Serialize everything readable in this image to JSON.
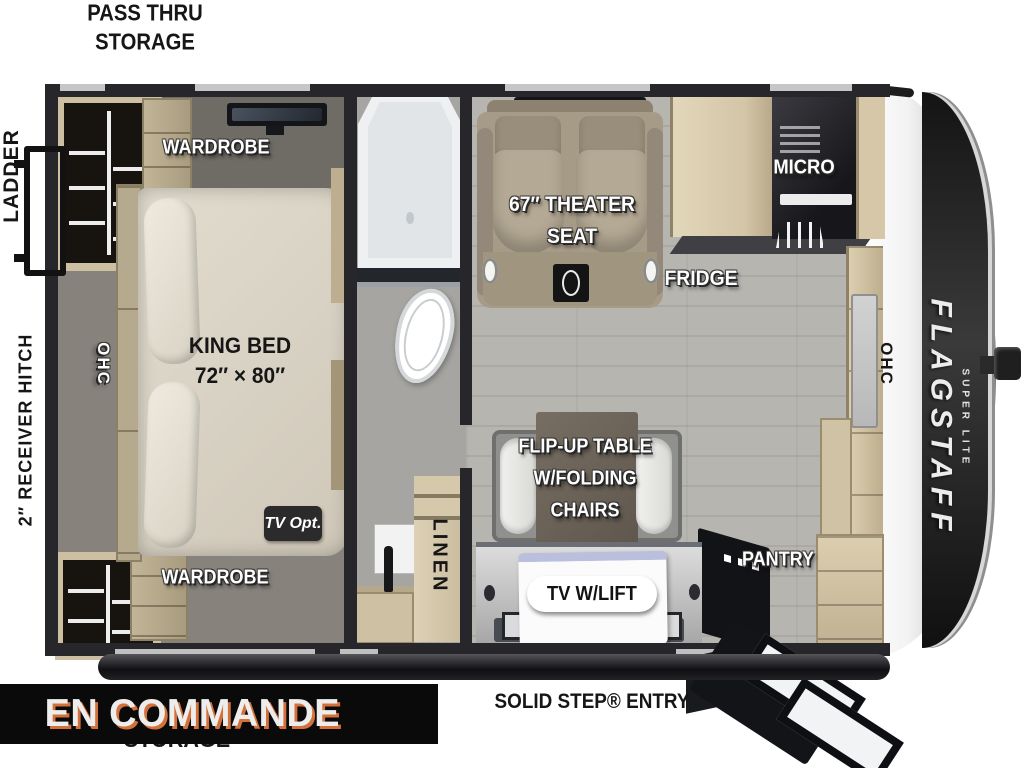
{
  "banner": {
    "label": "EN COMMANDE",
    "bg": "#0a0a0a",
    "text_color": "#ededed",
    "shadow_color": "#d4713a"
  },
  "exterior": {
    "pass_thru_line1": "PASS THRU",
    "pass_thru_line2": "STORAGE",
    "storage_bottom": "STORAGE",
    "ladder": "LADDER",
    "receiver_hitch": "2″ RECEIVER HITCH",
    "solid_step_entry": "SOLID STEP® ENTRY"
  },
  "bedroom": {
    "wardrobe_top": "WARDROBE",
    "wardrobe_bottom": "WARDROBE",
    "king_bed_line1": "KING BED",
    "king_bed_line2": "72″ × 80″",
    "ohc_left": "OHC",
    "tv_opt": "TV Opt."
  },
  "bathroom": {
    "linen": "LINEN"
  },
  "living": {
    "theater_line1": "67″ THEATER",
    "theater_line2": "SEAT",
    "fridge": "FRIDGE",
    "micro": "MICRO",
    "table_line1": "FLIP-UP TABLE",
    "table_line2": "W/FOLDING",
    "table_line3": "CHAIRS",
    "tv_lift": "TV W/LIFT",
    "pantry": "PANTRY",
    "ohc_right": "OHC"
  },
  "branding": {
    "model": "FLAGSTAFF",
    "trim": "SUPER LITE"
  },
  "colors": {
    "wall": "#26262b",
    "wood": "#cdbfa2",
    "living_floor": "#b7b5b0",
    "accent_orange": "#d4713a"
  }
}
